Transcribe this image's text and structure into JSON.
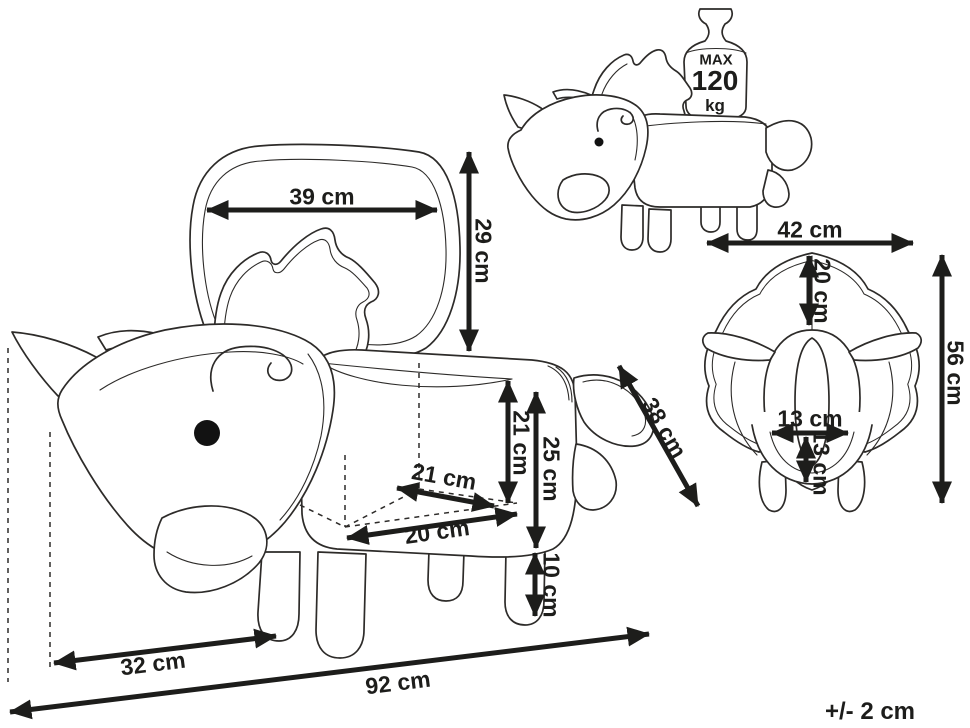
{
  "drawing": {
    "title": "triceratops storage stool dimension diagram",
    "views": {
      "side_view_open": {
        "lid_width": "39 cm",
        "lid_height": "29 cm",
        "inner_height": "21 cm",
        "seat_height": "25 cm",
        "leg_height": "10 cm",
        "inner_depth": "21 cm",
        "inner_width": "20 cm",
        "depth": "38 cm",
        "head_length": "32 cm",
        "total_length": "92 cm"
      },
      "side_view_closed": {
        "max_load_line1": "MAX",
        "max_load_line2": "120",
        "max_load_line3": "kg"
      },
      "front_view": {
        "width": "42 cm",
        "frill_height": "20 cm",
        "total_height": "56 cm",
        "mouth_width": "13 cm",
        "mouth_height": "13 cm"
      }
    },
    "tolerance": "+/- 2 cm",
    "colors": {
      "line": "#2d2b29",
      "dimension": "#1d1d1b",
      "background": "#ffffff"
    }
  }
}
